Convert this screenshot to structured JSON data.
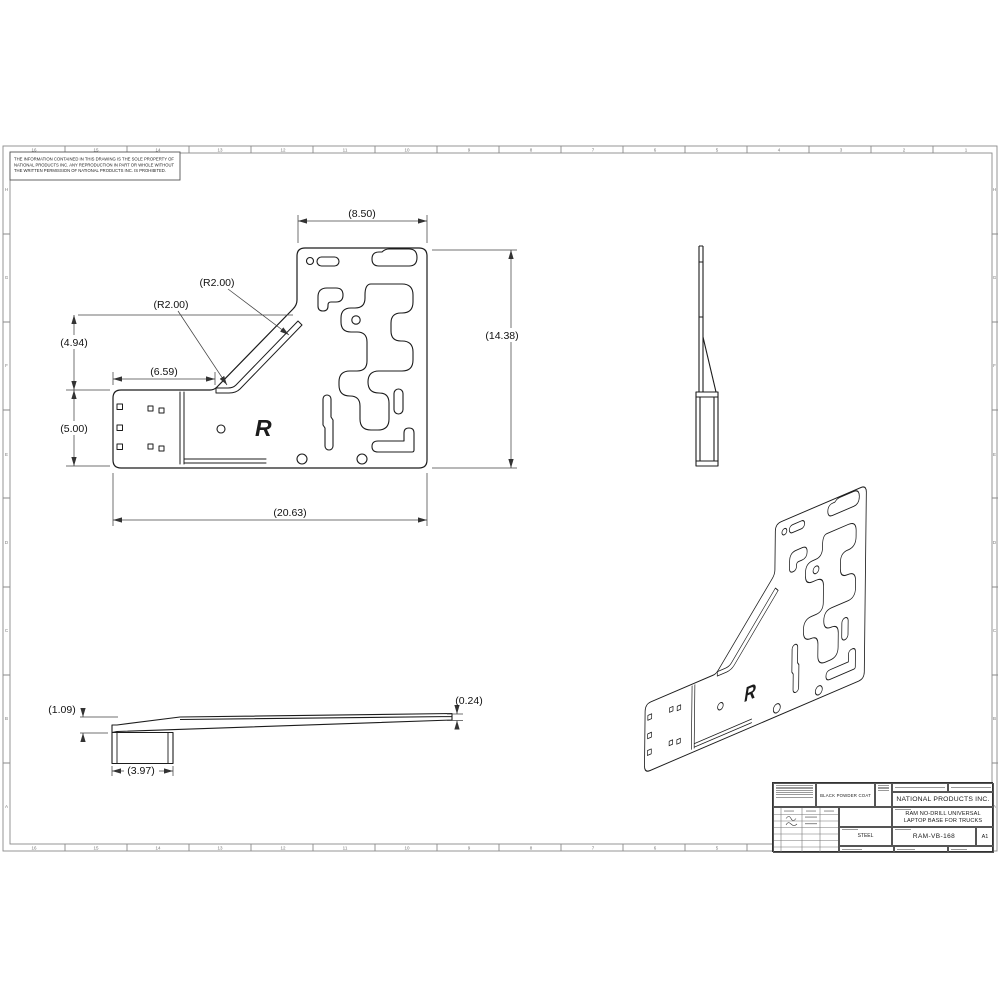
{
  "sheet": {
    "disclaimer": [
      "THE INFORMATION CONTAINED IN THIS DRAWING IS THE SOLE PROPERTY OF",
      "NATIONAL PRODUCTS INC.  ANY REPRODUCTION IN PART OR WHOLE WITHOUT",
      "THE WRITTEN PERMISSION OF NATIONAL PRODUCTS INC.  IS PROHIBITED."
    ],
    "zones_top": [
      "16",
      "15",
      "14",
      "13",
      "12",
      "11",
      "10",
      "9",
      "8",
      "7",
      "6",
      "5",
      "4",
      "3",
      "2",
      "1"
    ],
    "zones_side": [
      "H",
      "G",
      "F",
      "E",
      "D",
      "C",
      "B",
      "A"
    ]
  },
  "dims": {
    "plan_width_top": "(8.50)",
    "plan_height": "(14.38)",
    "plan_width_total": "(20.63)",
    "plan_upper_height": "(4.94)",
    "plan_arm_height": "(5.00)",
    "plan_arm_length": "(6.59)",
    "radius_upper": "(R2.00)",
    "radius_lower": "(R2.00)",
    "front_height": "(1.09)",
    "front_jaw_width": "(3.97)",
    "front_tip_thickness": "(0.24)"
  },
  "logo": {
    "ram_r": "R"
  },
  "title_block": {
    "finish": "BLACK POWDER COAT",
    "company": "NATIONAL PRODUCTS INC.",
    "title_line1": "RAM NO-DRILL UNIVERSAL",
    "title_line2": "LAPTOP BASE FOR TRUCKS",
    "material": "STEEL",
    "part_number": "RAM-VB-168",
    "revision": "A1"
  },
  "colors": {
    "line": "#1c1c1c",
    "dim_line": "#444",
    "frame": "#8a8a8a"
  }
}
